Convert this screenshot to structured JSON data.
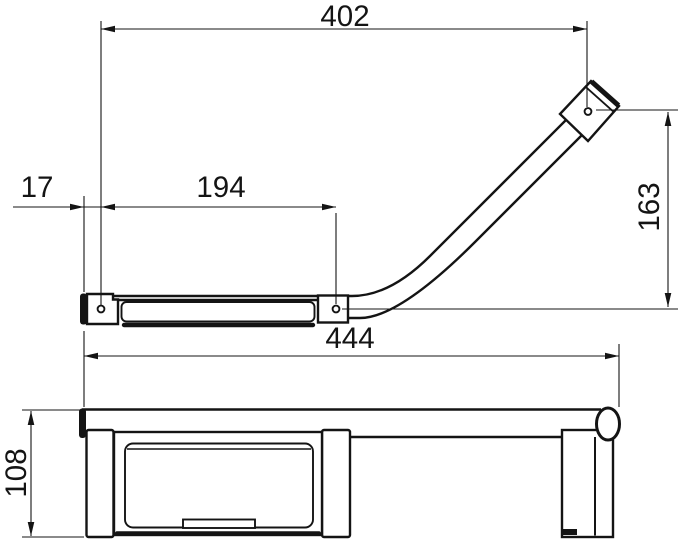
{
  "drawing": {
    "type": "technical-dimension-drawing",
    "line_color": "#141414",
    "background": "#ffffff"
  },
  "dimensions": {
    "top_length": "402",
    "left_offset": "17",
    "bracket_spacing": "194",
    "right_height": "163",
    "overall_width": "444",
    "left_height": "108"
  }
}
